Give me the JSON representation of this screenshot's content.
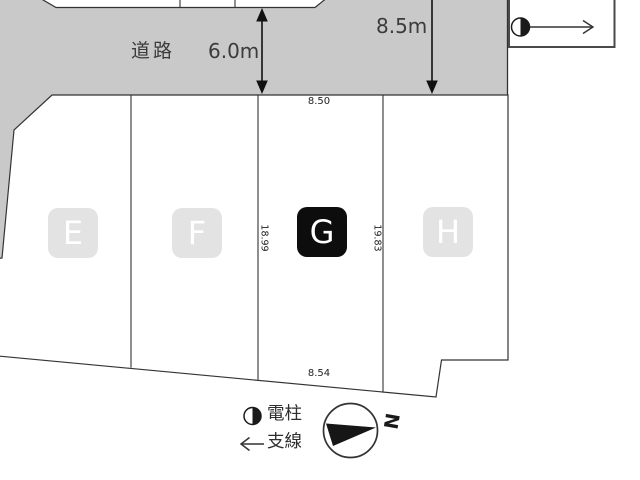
{
  "title": "residential lot site plan",
  "road": {
    "name_label": "道路",
    "width_label": "6.0m",
    "east_width_label": "8.5m"
  },
  "lots": {
    "items": [
      {
        "id": "E",
        "highlighted": false
      },
      {
        "id": "F",
        "highlighted": false
      },
      {
        "id": "G",
        "highlighted": true
      },
      {
        "id": "H",
        "highlighted": false
      }
    ]
  },
  "dimensions_lot_g": {
    "top": "8.50",
    "left": "18.99",
    "right": "19.83",
    "bottom": "8.54"
  },
  "legend": {
    "pole_label": "電柱",
    "guy_wire_label": "支線",
    "north_label": "N",
    "icons": [
      "utility-pole-icon",
      "guy-wire-arrow-icon",
      "north-compass-icon"
    ]
  },
  "colors": {
    "road_fill": "#c9c9c9",
    "lot_fill": "#ffffff",
    "badge_fill": "#e3e3e3",
    "badge_text": "#ffffff",
    "highlight_fill": "#0d0d0d",
    "line": "#333333"
  }
}
